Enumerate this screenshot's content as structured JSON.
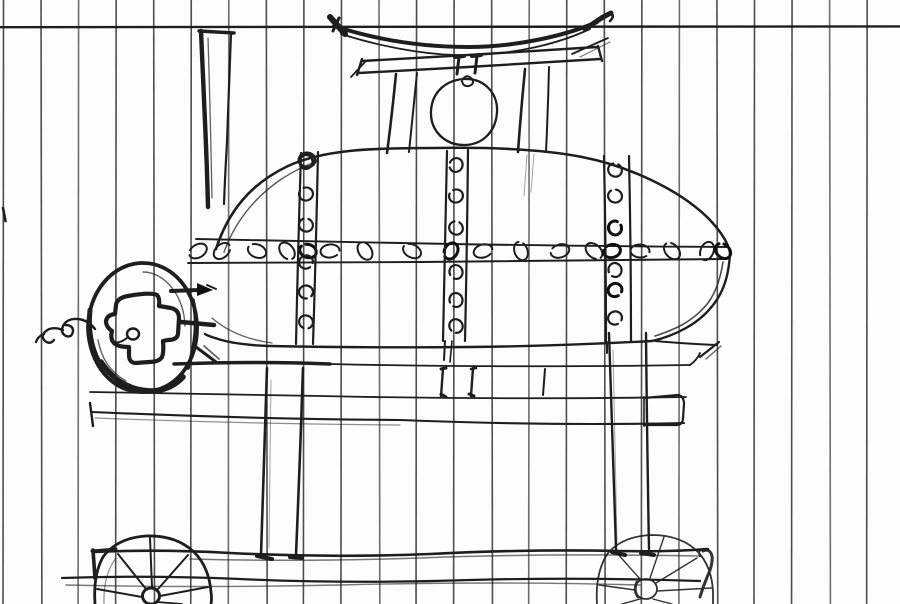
{
  "meta": {
    "description": "Scanned freehand pencil sketch on vertically ruled paper depicting a riveted cylindrical tank (smoker/boiler) on a four-legged wheeled cart, with a pagoda-style roof and hanging bell on top, a tall chimney stack at left, and a round end-cap door with a cross-shaped hatch, coil handle and pointer arrow.",
    "medium": "pencil on ruled paper, black-and-white scan"
  },
  "paper": {
    "background_color": "#fdfdfd",
    "rule_color": "#3f3f3f",
    "margin_rule_color": "#2b2b2b",
    "rule_first_x": 3.5,
    "rule_spacing_px": 37.55,
    "rule_count": 24,
    "margin_rule_y": 27
  },
  "ink": {
    "stroke_color": "#1e1e1e",
    "heavy_color": "#0f0f0f",
    "faint_color": "#555555"
  },
  "scene": {
    "elements": [
      {
        "name": "ruled-paper",
        "desc": "white paper with dark vertical rules and one horizontal rule near the top"
      },
      {
        "name": "chimney-stack",
        "desc": "tall tapering stack at upper left, heavy dark left edge"
      },
      {
        "name": "pagoda-roof",
        "desc": "curved roof with upswept dark tips over a double-line eave beam"
      },
      {
        "name": "bell",
        "desc": "round bell hanging from the beam on two short dark hangers"
      },
      {
        "name": "roof-posts",
        "desc": "two pairs of posts carrying the roof down to the tank top"
      },
      {
        "name": "boiler-tank",
        "desc": "large horizontal cylinder with rounded right end"
      },
      {
        "name": "rivet-band-horizontal",
        "desc": "riveted seam band across the middle of the tank"
      },
      {
        "name": "rivet-strips-vertical",
        "desc": "three vertical riveted seam strips (left, center, right)"
      },
      {
        "name": "end-cap-door",
        "desc": "round left end cap with heavy cross-shaped hatch, small knob, coil handle and pointer arrow"
      },
      {
        "name": "stand-frame",
        "desc": "horizontal shelf rails under the tank"
      },
      {
        "name": "legs",
        "desc": "two main tapered legs plus small center posts and a right-side bracket box"
      },
      {
        "name": "lower-rails",
        "desc": "two long wavy rails near the bottom joining the wheels"
      },
      {
        "name": "left-wheel",
        "desc": "dark spoked wheel with hub, bottom cropped by page edge"
      },
      {
        "name": "right-wheel",
        "desc": "faint spoked wheel with hub and dark mounting bracket"
      }
    ]
  },
  "rivets": {
    "band_y": 251,
    "band_x": [
      198,
      222,
      257,
      287,
      330,
      365,
      412,
      483,
      521,
      560,
      594,
      640,
      672,
      707
    ],
    "band_dark_x": [
      308,
      451,
      612,
      723
    ],
    "left_strip_x": 306,
    "left_strip_y": [
      162,
      194,
      225,
      262,
      292,
      322
    ],
    "center_strip_x": 456,
    "center_strip_y": [
      165,
      196,
      228,
      272,
      300,
      326
    ],
    "right_strip_x": 615,
    "right_strip_y": [
      170,
      196,
      228,
      270,
      290,
      318
    ]
  }
}
